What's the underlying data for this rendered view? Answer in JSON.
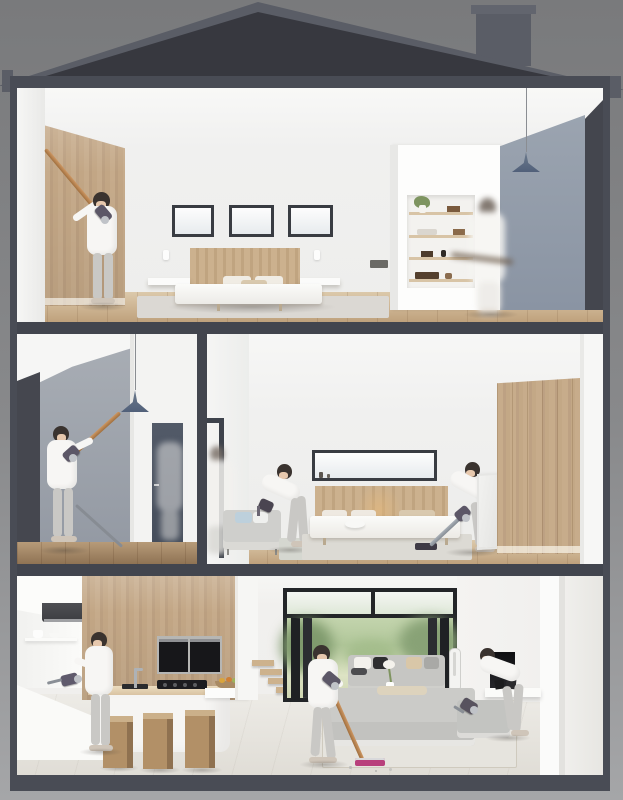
{
  "scene": {
    "title": "Cutaway dollhouse illustration of a three-storey house with women using cordless stick vacuums in every room",
    "roof_label": "Dark pitched roof with chimney",
    "floors": {
      "top": {
        "label": "Top floor open bedroom: wood panel wall, three small windows over a double bed, recessed shelving unit, grey-blue accent wall, pendant lamp; one woman vacuums high on the wall, a second blurred figure walks past"
      },
      "middle_left": {
        "label": "Middle floor landing: grey wall with charcoal edge, pendant lamp, stair rail and dark door; a woman reaches up with a stick vacuum"
      },
      "middle_right": {
        "label": "Middle floor bedroom: small sofa, double bed under a letterbox window, oak wardrobe wall, leaning mirror; one woman vacuums the sofa, another vacuums the floor, a blurred figure passes the door"
      },
      "ground": {
        "label": "Ground floor kitchen and living room: island with stools and double ovens, folding glass doors open to a green garden, grey corner sofas, tower fan and fireplace; one woman cleans at the counter, one vacuums the floor, one vacuums the sofa"
      }
    },
    "objects": {
      "kitchen_island": "White kitchen island with gas hob, sink and wooden cube stools",
      "glass_doors": "Black-framed folding glass doors opening to the garden",
      "garden": "Blurred green garden with lawn and trees",
      "bed_top": "Double bed with oak headboard and floating nightstands",
      "shelf_unit": "Recessed white shelving with plant and ornaments"
    }
  },
  "palette": {
    "backdrop_top": "#797a7c",
    "backdrop_bottom": "#a5a6a8",
    "frame": "#494c55",
    "roof": "#37383f",
    "roof_trim": "#5a5d66",
    "white_wall": "#f1f1f0",
    "grey_blue_wall": "#96a0ac",
    "charcoal_wall": "#44464e",
    "light_oak": "#c4a988",
    "floor_wood": "#c9ad89",
    "sofa_grey": "#c7c7c4",
    "garden_green": "#b4c99c",
    "lamp_shade": "#5d6a7b",
    "vacuum_copper": "#b5844f",
    "vacuum_body_purple": "#5c5767",
    "vacuum_head_pink": "#b8407c",
    "appliance_black": "#1a1a1d"
  }
}
